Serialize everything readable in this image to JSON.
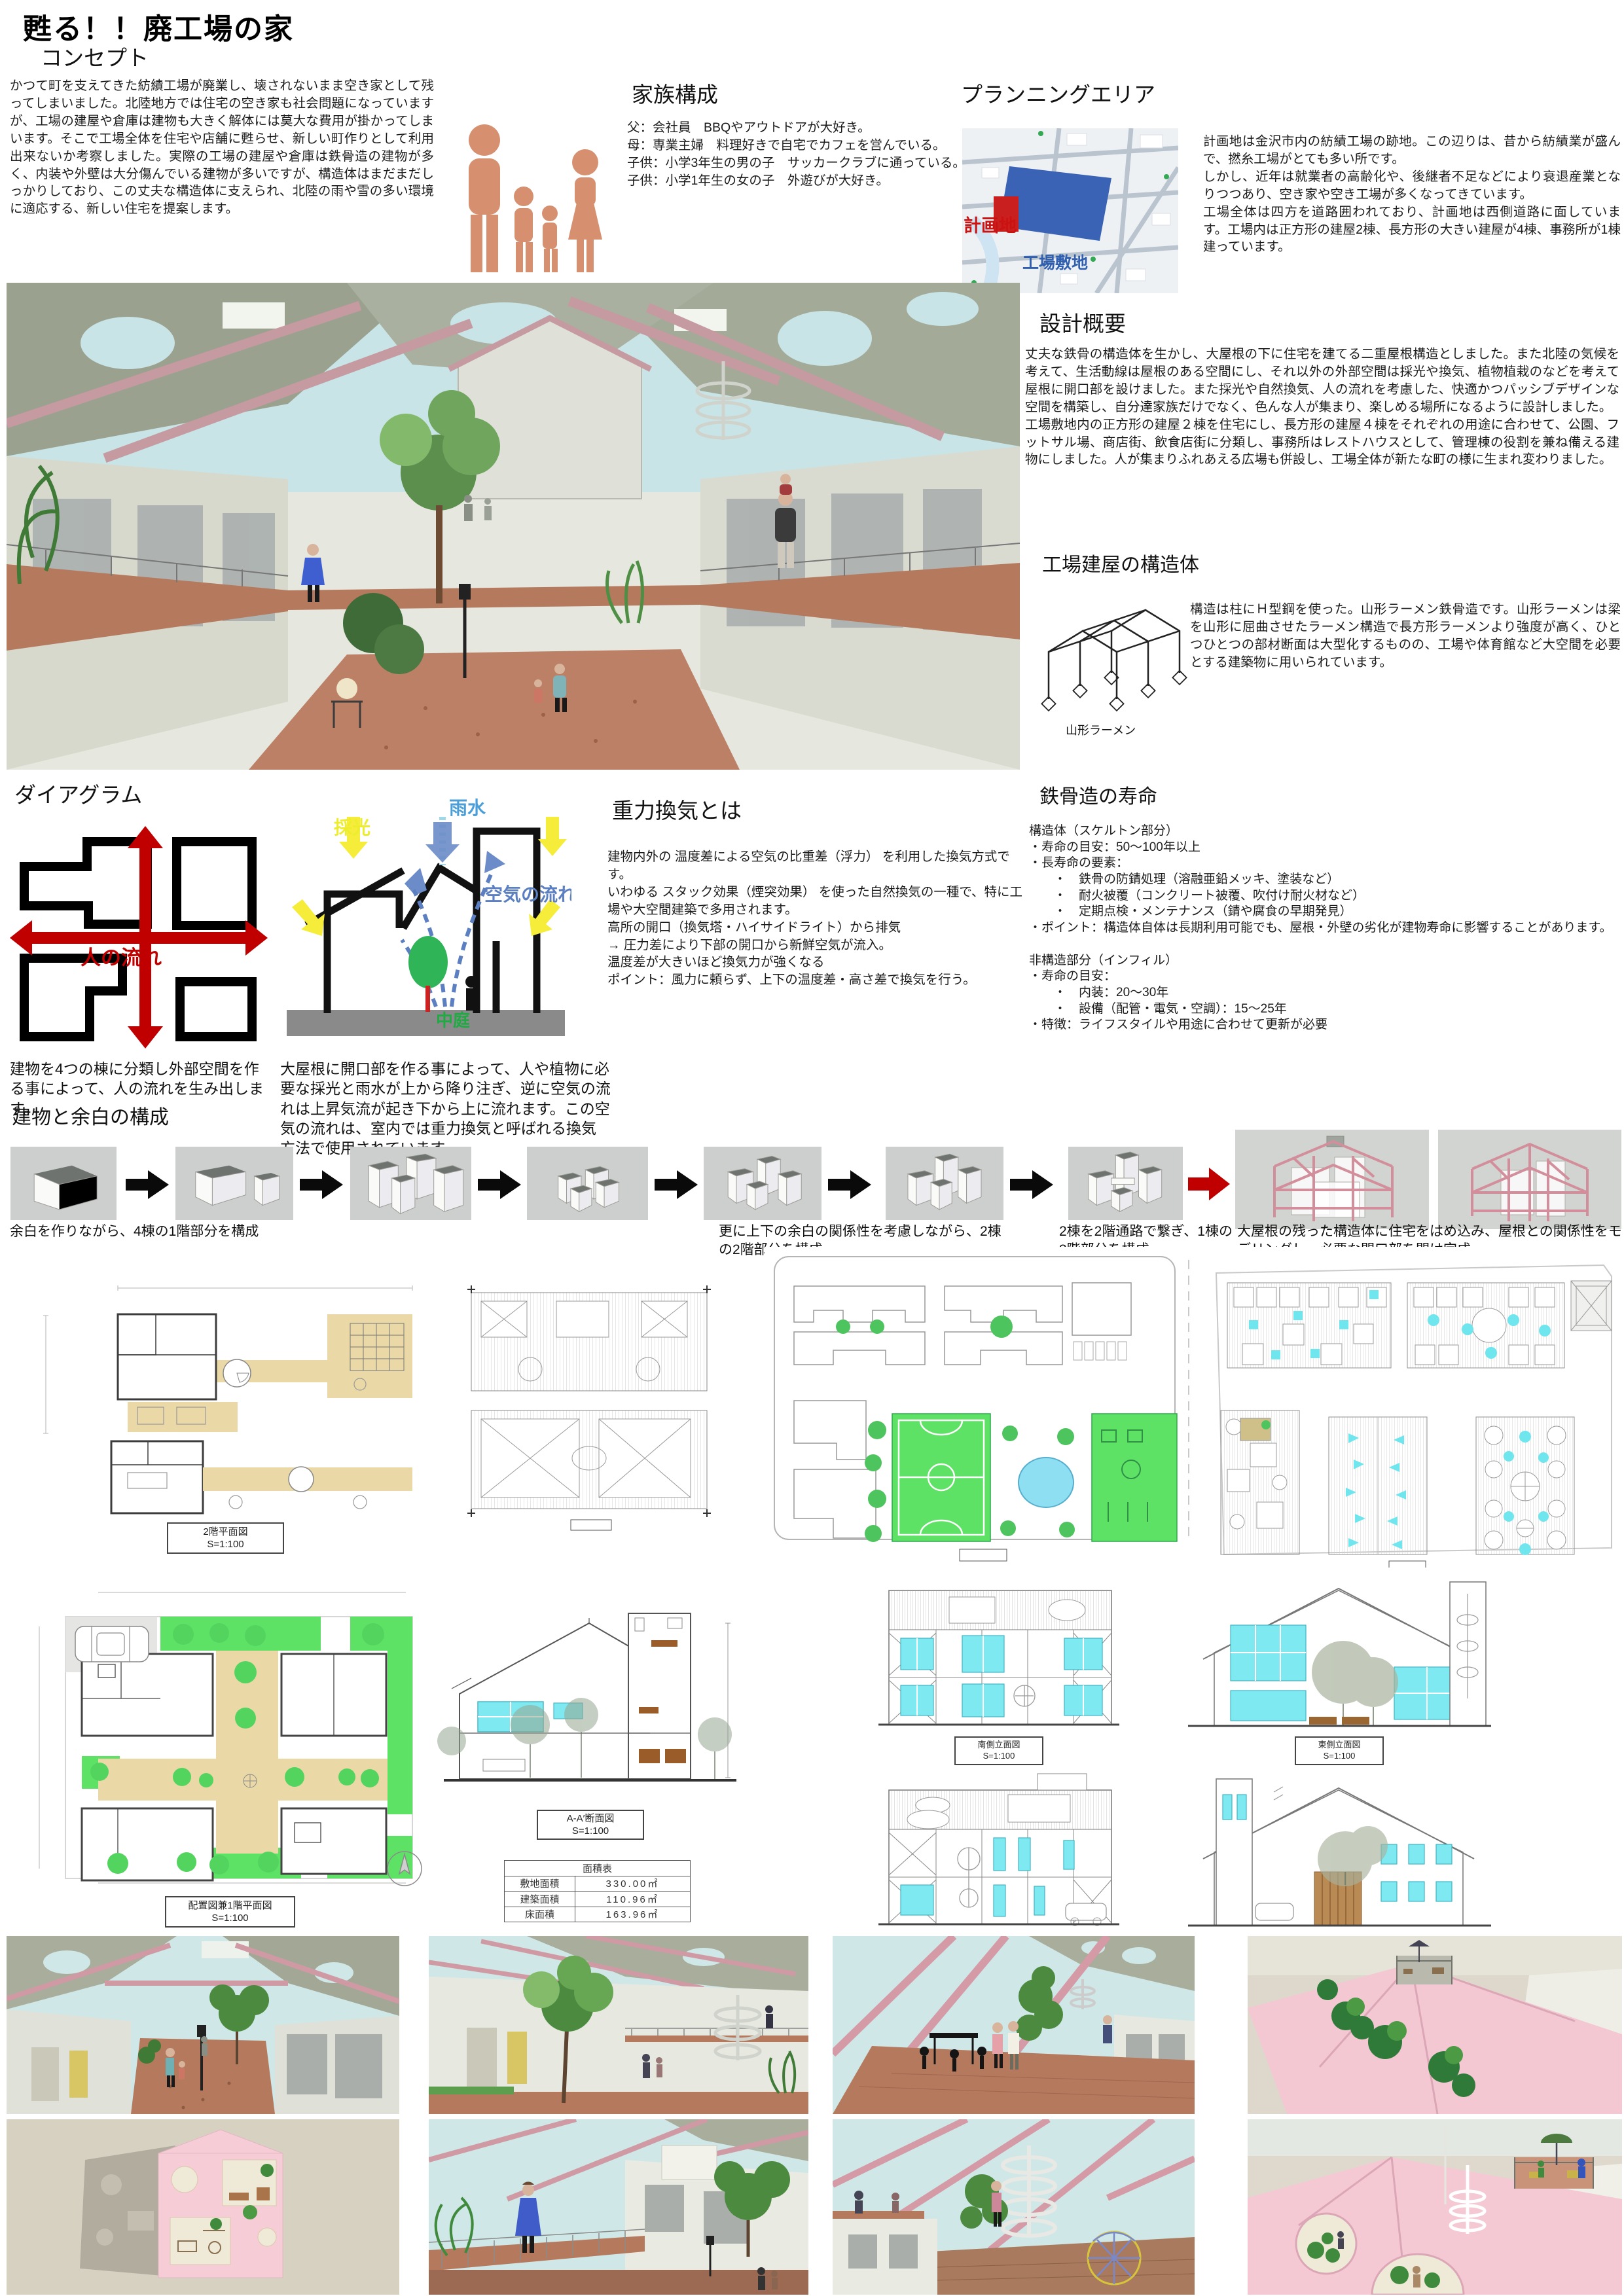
{
  "page": {
    "title": "甦る！！廃工場の家"
  },
  "concept": {
    "heading": "コンセプト",
    "body": "かつて町を支えてきた紡績工場が廃業し、壊されないまま空き家として残ってしまいました。北陸地方では住宅の空き家も社会問題になっていますが、工場の建屋や倉庫は建物も大きく解体には莫大な費用が掛かってしまいます。そこで工場全体を住宅や店舗に甦らせ、新しい町作りとして利用出来ないか考察しました。実際の工場の建屋や倉庫は鉄骨造の建物が多く、内装や外壁は大分傷んでいる建物が多いですが、構造体はまだまだしっかりしており、この丈夫な構造体に支えられ、北陸の雨や雪の多い環境に適応する、新しい住宅を提案します。"
  },
  "family": {
    "heading": "家族構成",
    "body": "父：会社員　BBQやアウトドアが大好き。\n母：専業主婦　料理好きで自宅でカフェを営んでいる。\n子供：小学3年生の男の子　サッカークラブに通っている。\n子供：小学1年生の女の子　外遊びが大好き。"
  },
  "planning": {
    "heading": "プランニングエリア",
    "site_label": "計画地",
    "factory_label": "工場敷地",
    "body": "計画地は金沢市内の紡績工場の跡地。この辺りは、昔から紡績業が盛んで、撚糸工場がとても多い所です。\nしかし、近年は就業者の高齢化や、後継者不足などにより衰退産業となりつつあり、空き家や空き工場が多くなってきています。\n工場全体は四方を道路囲われており、計画地は西側道路に面しています。工場内は正方形の建屋2棟、長方形の大きい建屋が4棟、事務所が1棟建っています。"
  },
  "design": {
    "heading": "設計概要",
    "body": "丈夫な鉄骨の構造体を生かし、大屋根の下に住宅を建てる二重屋根構造としました。また北陸の気候を考えて、生活動線は屋根のある空間にし、それ以外の外部空間は採光や換気、植物植栽のなどを考えて屋根に開口部を設けました。また採光や自然換気、人の流れを考慮した、快適かつパッシブデザインな空間を構築し、自分達家族だけでなく、色んな人が集まり、楽しめる場所になるように設計しました。\n工場敷地内の正方形の建屋２棟を住宅にし、長方形の建屋４棟をそれぞれの用途に合わせて、公園、フットサル場、商店街、飲食店街に分類し、事務所はレストハウスとして、管理棟の役割を兼ね備える建物にしました。人が集まりふれあえる広場も併設し、工場全体が新たな町の様に生まれ変わりました。"
  },
  "structure": {
    "heading": "工場建屋の構造体",
    "body": "構造は柱にＨ型鋼を使った。山形ラーメン鉄骨造です。山形ラーメンは梁を山形に屈曲させたラーメン構造で長方形ラーメンより強度が高く、ひとつひとつの部材断面は大型化するものの、工場や体育館など大空間を必要とする建築物に用いられています。",
    "caption": "山形ラーメン"
  },
  "diagram": {
    "heading": "ダイアグラム",
    "flow_label": "人の流れ",
    "flow_caption": "建物を4つの棟に分類し外部空間を作る事によって、人の流れを生み出します。",
    "daylight_label": "採光",
    "rain_label": "雨水",
    "air_label": "空気の流れ",
    "courtyard_label": "中庭",
    "vent_caption": "大屋根に開口部を作る事によって、人や植物に必要な採光と雨水が上から降り注ぎ、逆に空気の流れは上昇気流が起き下から上に流れます。この空気の流れは、室内では重力換気と呼ばれる換気方法で使用されています。"
  },
  "gravity": {
    "heading": "重力換気とは",
    "body": "建物内外の 温度差による空気の比重差（浮力） を利用した換気方式です。\nいわゆる スタック効果（煙突効果） を使った自然換気の一種で、特に工場や大空間建築で多用されます。\n高所の開口（換気塔・ハイサイドライト）から排気\n→ 圧力差により下部の開口から新鮮空気が流入。\n温度差が大きいほど換気力が強くなる\nポイント：風力に頼らず、上下の温度差・高さ差で換気を行う。"
  },
  "steel": {
    "heading": "鉄骨造の寿命",
    "body": "構造体（スケルトン部分）\n・寿命の目安：50～100年以上\n・長寿命の要素：\n　　・　鉄骨の防錆処理（溶融亜鉛メッキ、塗装など）\n　　・　耐火被覆（コンクリート被覆、吹付け耐火材など）\n　　・　定期点検・メンテナンス（錆や腐食の早期発見）\n・ポイント：構造体自体は長期利用可能でも、屋根・外壁の劣化が建物寿命に影響することがあります。\n\n非構造部分（インフィル）\n・寿命の目安：\n　　・　内装：20～30年\n　　・　設備（配管・電気・空調）：15～25年\n・特徴：ライフスタイルや用途に合わせて更新が必要"
  },
  "massing": {
    "heading": "建物と余白の構成",
    "captions": [
      "余白を作りながら、4棟の1階部分を構成",
      "更に上下の余白の関係性を考慮しながら、2棟の2階部分を構成",
      "2棟を2階通路で繋ぎ、1棟の3階部分を構成",
      "大屋根の残った構造体に住宅をはめ込み、屋根との関係性をモデリングし、必要な開口部を開け完成"
    ]
  },
  "drawings": {
    "plan2f_label": "2階平面図",
    "site_plan_label": "配置図兼1階平面図",
    "section_label": "A-A′断面図",
    "scale": "S=1:100",
    "area_table": {
      "title": "面積表",
      "rows": [
        {
          "name": "敷地面積",
          "value": "330.00㎡"
        },
        {
          "name": "建築面積",
          "value": "110.96㎡"
        },
        {
          "name": "床面積",
          "value": "163.96㎡"
        }
      ]
    },
    "elevations": [
      "南側立面図",
      "東側立面図",
      "北側立面図",
      "西側立面図"
    ]
  },
  "colors": {
    "accent_red": "#c00000",
    "map_site_red": "#c9201f",
    "map_factory_blue": "#3a63b5",
    "window_cyan": "#7ee9f0",
    "lawn_green": "#5ee266",
    "deck_tan": "#e9dcab",
    "frame_pink": "#e3a7b0",
    "figure_salmon": "#d6906f"
  }
}
